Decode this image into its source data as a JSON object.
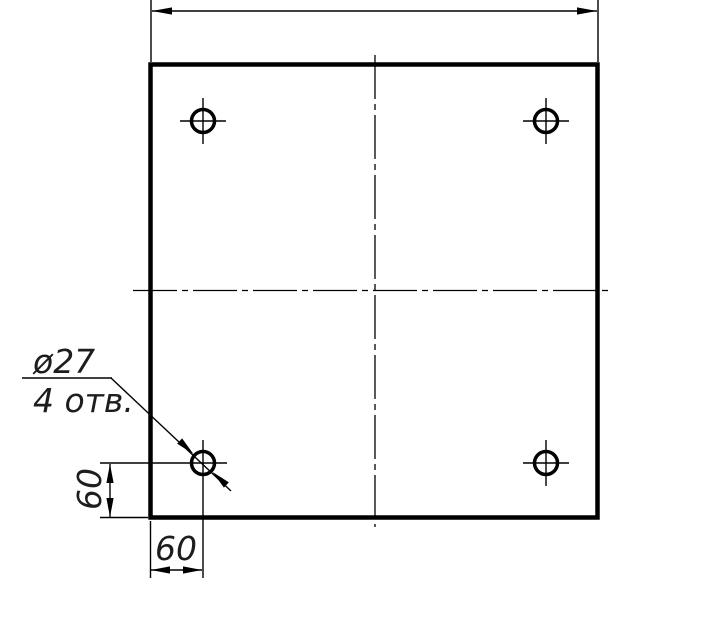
{
  "drawing": {
    "background_color": "#ffffff",
    "line_color": "#000000",
    "text_color": "#1d1d1d",
    "holes_count": 4,
    "hole_callout": {
      "diameter_label": "ø27",
      "count_label": "4 отв."
    },
    "dimensions": {
      "hole_offset_vertical_label": "60",
      "hole_offset_horizontal_label": "60"
    }
  }
}
